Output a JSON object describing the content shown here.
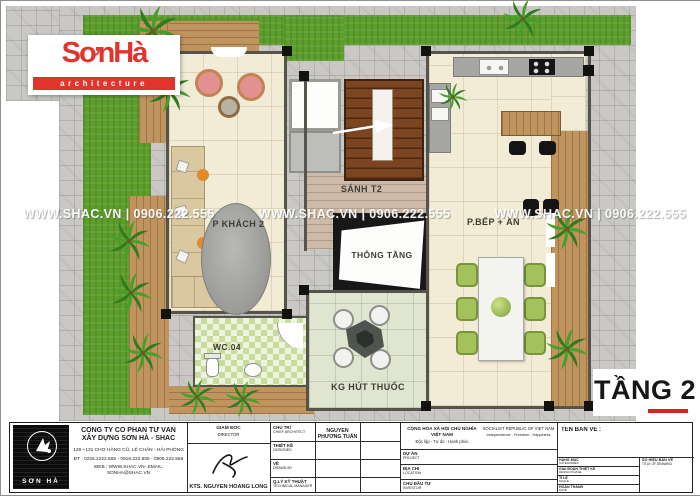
{
  "logo": {
    "brand": "SơnHà",
    "sub": "architecture"
  },
  "watermark": {
    "text": "WWW.SHAC.VN  |  0906.222.555"
  },
  "plan": {
    "floor_label": "TẦNG 2",
    "rooms": [
      {
        "id": "living",
        "label": "P KHÁCH 2"
      },
      {
        "id": "hall",
        "label": "SÁNH T2"
      },
      {
        "id": "void",
        "label": "THÔNG TẦNG"
      },
      {
        "id": "kitchen",
        "label": "P.BẾP + ĂN"
      },
      {
        "id": "wc",
        "label": "WC.04"
      },
      {
        "id": "smoking",
        "label": "KG HÚT THUỐC"
      }
    ]
  },
  "titleblock": {
    "company": {
      "logo_text": "SƠN HÀ",
      "name_line1": "CÔNG TY CỔ PHẦN TƯ VẤN",
      "name_line2": "XÂY DỰNG SƠN HÀ - SHAC",
      "address": "129 +131 CHỢ HÀNG CŨ, LÊ CHÂN - HẢI PHÒNG",
      "phone": "ĐT : 0225.2222.555 - 0916.222.555 - 0906.222.555",
      "web": "WEB : WWW.SHAC.VN- EMAIL: SONHA@SHAC.VN"
    },
    "director": {
      "label_vi": "GIÁM ĐỐC",
      "label_en": "DIRECTOR",
      "name": "KTS. NGUYỄN HOÀNG LONG"
    },
    "staff_rows": [
      {
        "label_vi": "CHỦ TRÌ",
        "label_en": "CHIEF ARCHITECT",
        "value": "NGUYỄN PHƯƠNG TUẤN"
      },
      {
        "label_vi": "THIẾT KẾ",
        "label_en": "DESIGNED",
        "value": ""
      },
      {
        "label_vi": "VẼ",
        "label_en": "DRAWN BY",
        "value": ""
      },
      {
        "label_vi": "Q.LÝ KỸ THUẬT",
        "label_en": "TECHNICAL MANAGER",
        "value": ""
      }
    ],
    "republic": {
      "vi_line1": "CỘNG HÒA XÃ HỘI CHỦ NGHĨA VIỆT NAM",
      "vi_line2": "Độc lập - Tự do - Hạnh phúc",
      "en_line1": "SOCIALIST REPUBLIC OF VIET NAM",
      "en_line2": "Independence - Freedom - Happiness"
    },
    "project_rows": [
      {
        "label_vi": "DỰ ÁN",
        "label_en": "PROJECT",
        "value": ""
      },
      {
        "label_vi": "ĐỊA CHỈ",
        "label_en": "LOCATION",
        "value": ""
      },
      {
        "label_vi": "CHỦ ĐẦU TƯ",
        "label_en": "INVESTOR",
        "value": ""
      }
    ],
    "drawing": {
      "title_label": "TÊN BẢN VẼ :",
      "rows": [
        {
          "label_vi": "HẠNG MỤC",
          "label_en": "CATEGORIES"
        },
        {
          "label_vi": "GIAI ĐOẠN THIẾT KẾ",
          "label_en": "DESIGN PHASE"
        },
        {
          "label_vi": "TỈ LỆ",
          "label_en": "SCALE"
        },
        {
          "label_vi": "HOÀN THÀNH",
          "label_en": "DATE"
        }
      ],
      "number_label_vi": "SỐ HIỆU BẢN VẼ",
      "number_label_en": "TITLE OF DRAWING"
    }
  },
  "colors": {
    "brand_red": "#e3342b",
    "floor_label_underline": "#e01f1f",
    "grass": "#5d9d2c",
    "paving": "#c9c8c4"
  }
}
